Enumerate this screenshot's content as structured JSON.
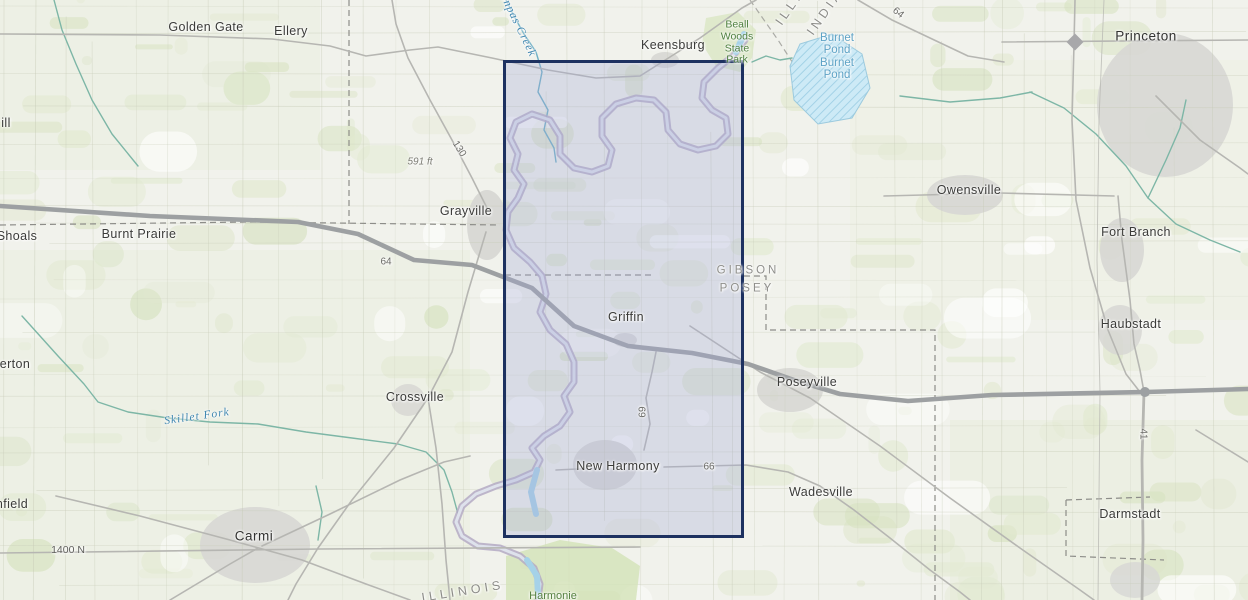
{
  "map": {
    "description": "topographic-basemap-with-selection-extent",
    "selection": {
      "x": 503,
      "y": 60,
      "width": 241,
      "height": 478,
      "fill": "rgba(166,170,215,0.32)",
      "border_color": "#1d3160"
    },
    "colors": {
      "land": "#f1f2ec",
      "vegetation": "#e2e9d1",
      "vegetation_dark": "#d7e2c0",
      "urban": "#d7d7d4",
      "road": "#b6b6b2",
      "highway": "#9da0a2",
      "river": "#b4aac4",
      "river_core": "#dee2ec",
      "water": "#a5d2e8",
      "pond_fill": "#cdeaf6",
      "pond_edge": "#9ccade",
      "stream": "#7db6a6",
      "boundary": "#8d8d89",
      "grid": "#c6cab6",
      "park": "#d8e6c2"
    },
    "labels": [
      {
        "id": "town-ill-partial",
        "text": "ill",
        "x": 6,
        "y": 124,
        "kind": "town"
      },
      {
        "id": "town-golden-gate",
        "text": "Golden Gate",
        "x": 206,
        "y": 28,
        "kind": "town"
      },
      {
        "id": "town-ellery",
        "text": "Ellery",
        "x": 291,
        "y": 32,
        "kind": "town"
      },
      {
        "id": "town-keensburg",
        "text": "Keensburg",
        "x": 673,
        "y": 46,
        "kind": "town"
      },
      {
        "id": "park-beall-woods",
        "text": "Beall\nWoods\nState\nPark",
        "x": 737,
        "y": 43,
        "kind": "park"
      },
      {
        "id": "pond-burnet",
        "text": "Burnet\nPond\nBurnet\nPond",
        "x": 837,
        "y": 57,
        "kind": "pond"
      },
      {
        "id": "state-illinois-top",
        "text": "ILLINOIS",
        "x": 803,
        "y": -10,
        "kind": "state",
        "r": -55
      },
      {
        "id": "state-indiana-top",
        "text": "INDIANA",
        "x": 833,
        "y": 2,
        "kind": "state",
        "r": -55
      },
      {
        "id": "road-64-northeast",
        "text": "64",
        "x": 898,
        "y": 13,
        "kind": "road",
        "r": 38
      },
      {
        "id": "city-princeton",
        "text": "Princeton",
        "x": 1146,
        "y": 37,
        "kind": "city"
      },
      {
        "id": "stream-bonpas-creek",
        "text": "Bonpas Creek",
        "x": 516,
        "y": 22,
        "kind": "stream",
        "r": 64
      },
      {
        "id": "elev-591-ft",
        "text": "591 ft",
        "x": 420,
        "y": 162,
        "kind": "elev"
      },
      {
        "id": "road-130",
        "text": "130",
        "x": 459,
        "y": 149,
        "kind": "road",
        "r": 58
      },
      {
        "id": "town-grayville",
        "text": "Grayville",
        "x": 466,
        "y": 212,
        "kind": "town"
      },
      {
        "id": "town-shoals-partial",
        "text": "Shoals",
        "x": 17,
        "y": 237,
        "kind": "town"
      },
      {
        "id": "town-burnt-prairie",
        "text": "Burnt Prairie",
        "x": 139,
        "y": 235,
        "kind": "town"
      },
      {
        "id": "road-64-west",
        "text": "64",
        "x": 386,
        "y": 262,
        "kind": "road"
      },
      {
        "id": "county-gibson",
        "text": "GIBSON",
        "x": 748,
        "y": 271,
        "kind": "county"
      },
      {
        "id": "county-posey",
        "text": "POSEY",
        "x": 747,
        "y": 289,
        "kind": "county"
      },
      {
        "id": "town-griffin",
        "text": "Griffin",
        "x": 626,
        "y": 318,
        "kind": "town"
      },
      {
        "id": "town-owensville",
        "text": "Owensville",
        "x": 969,
        "y": 191,
        "kind": "town"
      },
      {
        "id": "town-fort-branch",
        "text": "Fort Branch",
        "x": 1136,
        "y": 233,
        "kind": "town"
      },
      {
        "id": "town-haubstadt",
        "text": "Haubstadt",
        "x": 1131,
        "y": 325,
        "kind": "town"
      },
      {
        "id": "town-poseyville",
        "text": "Poseyville",
        "x": 807,
        "y": 383,
        "kind": "town"
      },
      {
        "id": "town-crossville",
        "text": "Crossville",
        "x": 415,
        "y": 398,
        "kind": "town"
      },
      {
        "id": "town-erton-partial",
        "text": "erton",
        "x": 15,
        "y": 365,
        "kind": "town"
      },
      {
        "id": "stream-skillet-fork",
        "text": "Skillet Fork",
        "x": 197,
        "y": 417,
        "kind": "stream",
        "r": -8
      },
      {
        "id": "road-69",
        "text": "69",
        "x": 643,
        "y": 412,
        "kind": "road",
        "r": -90
      },
      {
        "id": "town-new-harmony",
        "text": "New Harmony",
        "x": 618,
        "y": 467,
        "kind": "town"
      },
      {
        "id": "road-66",
        "text": "66",
        "x": 709,
        "y": 467,
        "kind": "road"
      },
      {
        "id": "town-wadesville",
        "text": "Wadesville",
        "x": 821,
        "y": 493,
        "kind": "town"
      },
      {
        "id": "road-41",
        "text": "41",
        "x": 1143,
        "y": 434,
        "kind": "road",
        "r": 90
      },
      {
        "id": "town-nfield-partial",
        "text": "nfield",
        "x": 12,
        "y": 505,
        "kind": "town"
      },
      {
        "id": "city-carmi",
        "text": "Carmi",
        "x": 254,
        "y": 537,
        "kind": "city"
      },
      {
        "id": "road-1400-n",
        "text": "1400 N",
        "x": 68,
        "y": 551,
        "kind": "road-grid"
      },
      {
        "id": "town-darmstadt",
        "text": "Darmstadt",
        "x": 1130,
        "y": 515,
        "kind": "town"
      },
      {
        "id": "state-illinois-bottom",
        "text": "ILLINOIS",
        "x": 463,
        "y": 592,
        "kind": "state",
        "r": -9
      },
      {
        "id": "park-harmonie",
        "text": "Harmonie",
        "x": 553,
        "y": 596,
        "kind": "park-lg"
      }
    ]
  }
}
